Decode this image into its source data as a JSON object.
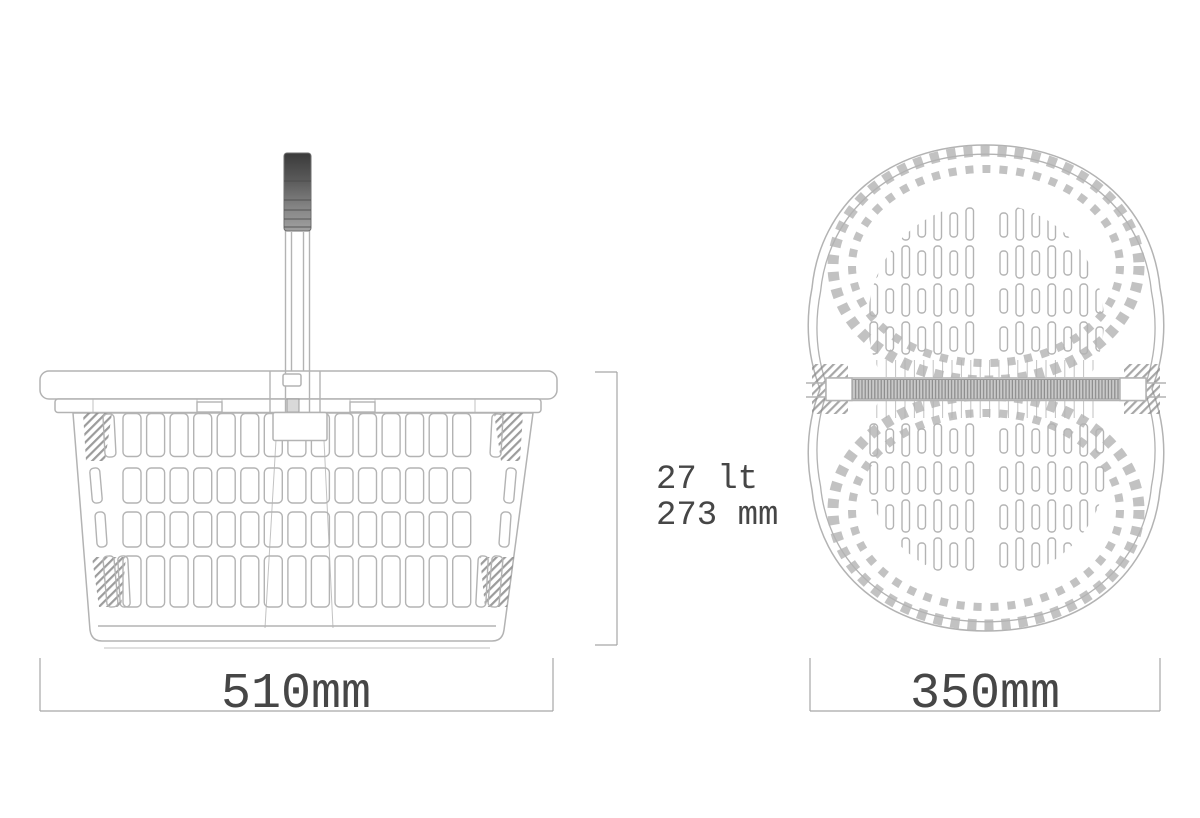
{
  "views": {
    "side": {
      "width_label": "510mm"
    },
    "top": {
      "width_label": "350mm"
    }
  },
  "annotations": {
    "capacity": "27 lt",
    "height": "273 mm"
  },
  "colors": {
    "background": "#ffffff",
    "line": "#b3b3b3",
    "line_dark": "#8e8e8e",
    "text": "#464646",
    "dim": "#a6a6a6",
    "grip_dark": "#3a3a3a",
    "grip_light": "#a0a0a0",
    "hatch": "#8a8a8a",
    "bar_fill": "#c9c9c9"
  }
}
